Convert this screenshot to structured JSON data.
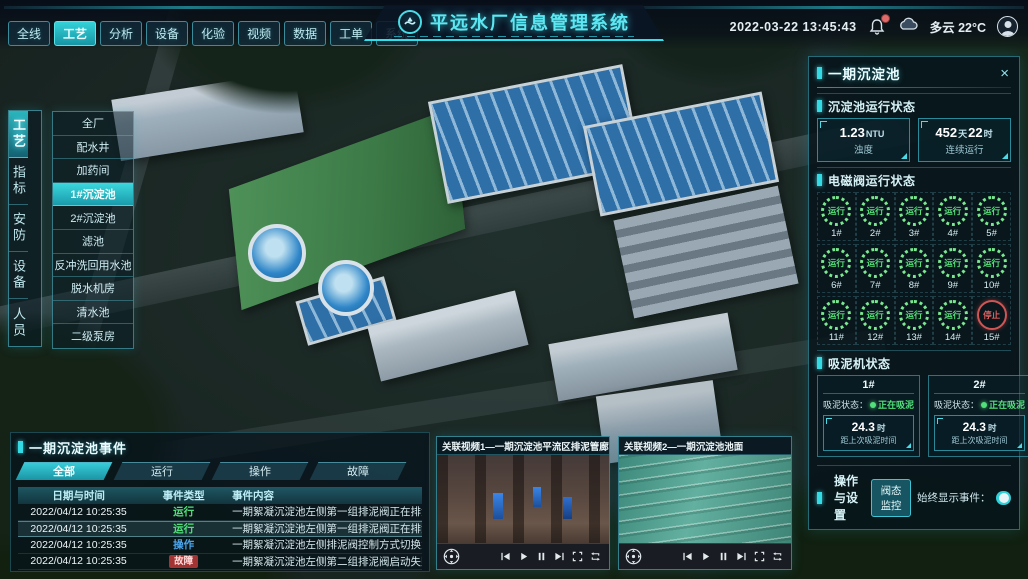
{
  "colors": {
    "accent": "#35dbe4",
    "run_green": "#52e07a",
    "op_blue": "#4aa3e8",
    "alarm_red": "#e05555",
    "panel_border": "#2f8fa3"
  },
  "icons": {
    "close": "×",
    "logo": "water-wave-logo",
    "alerts": "bell-icon",
    "weather": "cloud-icon",
    "user": "avatar-icon"
  },
  "header": {
    "title": "平远水厂信息管理系统",
    "datetime": "2022-03-22 13:45:43",
    "weather": "多云 22°C",
    "nav_tabs": [
      {
        "label": "全线"
      },
      {
        "label": "工艺",
        "active": true
      },
      {
        "label": "分析"
      },
      {
        "label": "设备"
      },
      {
        "label": "化验"
      },
      {
        "label": "视频"
      },
      {
        "label": "数据"
      },
      {
        "label": "工单"
      },
      {
        "label": "系统"
      }
    ]
  },
  "side_tabs": [
    {
      "label": "工艺",
      "active": true
    },
    {
      "label": "指标"
    },
    {
      "label": "安防"
    },
    {
      "label": "设备"
    },
    {
      "label": "人员"
    }
  ],
  "process_menu": {
    "items": [
      {
        "label": "全厂"
      },
      {
        "label": "配水井"
      },
      {
        "label": "加药间"
      },
      {
        "label": "1#沉淀池",
        "active": true
      },
      {
        "label": "2#沉淀池"
      },
      {
        "label": "滤池"
      },
      {
        "label": "反冲洗回用水池"
      },
      {
        "label": "脱水机房"
      },
      {
        "label": "清水池"
      },
      {
        "label": "二级泵房"
      }
    ]
  },
  "right_panel": {
    "title": "一期沉淀池",
    "close_icon": "×",
    "run_status": {
      "section_title": "沉淀池运行状态",
      "stats": [
        {
          "v1": "1.23",
          "u1": "NTU",
          "label": "浊度"
        },
        {
          "v1": "452",
          "u1": "天",
          "v2": "22",
          "u2": "时",
          "label": "连续运行"
        }
      ]
    },
    "valve_section": {
      "section_title": "电磁阀运行状态",
      "valves": [
        {
          "id": "1#",
          "status": "运行",
          "state": "run"
        },
        {
          "id": "2#",
          "status": "运行",
          "state": "run"
        },
        {
          "id": "3#",
          "status": "运行",
          "state": "run"
        },
        {
          "id": "4#",
          "status": "运行",
          "state": "run"
        },
        {
          "id": "5#",
          "status": "运行",
          "state": "run"
        },
        {
          "id": "6#",
          "status": "运行",
          "state": "run"
        },
        {
          "id": "7#",
          "status": "运行",
          "state": "run"
        },
        {
          "id": "8#",
          "status": "运行",
          "state": "run"
        },
        {
          "id": "9#",
          "status": "运行",
          "state": "run"
        },
        {
          "id": "10#",
          "status": "运行",
          "state": "run"
        },
        {
          "id": "11#",
          "status": "运行",
          "state": "run"
        },
        {
          "id": "12#",
          "status": "运行",
          "state": "run"
        },
        {
          "id": "13#",
          "status": "运行",
          "state": "run"
        },
        {
          "id": "14#",
          "status": "运行",
          "state": "run"
        },
        {
          "id": "15#",
          "status": "停止",
          "state": "stop"
        }
      ]
    },
    "mud_section": {
      "section_title": "吸泥机状态",
      "machines": [
        {
          "id": "1#",
          "status_label": "吸泥状态：",
          "status": "正在吸泥",
          "v": "24.3",
          "u": "时",
          "label": "距上次吸泥时间"
        },
        {
          "id": "2#",
          "status_label": "吸泥状态：",
          "status": "正在吸泥",
          "v": "24.3",
          "u": "时",
          "label": "距上次吸泥时间"
        }
      ]
    },
    "settings": {
      "section_title": "操作与设置",
      "button_label": "阀态监控",
      "toggle_label": "始终显示事件：",
      "toggle_state": "on"
    }
  },
  "events_panel": {
    "title": "一期沉淀池事件",
    "tabs": [
      {
        "label": "全部",
        "active": true
      },
      {
        "label": "运行"
      },
      {
        "label": "操作"
      },
      {
        "label": "故障"
      }
    ],
    "columns": [
      "日期与时间",
      "事件类型",
      "事件内容"
    ],
    "rows": [
      {
        "time": "2022/04/12 10:25:35",
        "type": "运行",
        "kind": "run",
        "content": "一期絮凝沉淀池左侧第一组排泥阀正在排泥"
      },
      {
        "time": "2022/04/12 10:25:35",
        "type": "运行",
        "kind": "run",
        "content": "一期絮凝沉淀池左侧第一组排泥阀正在排泥",
        "sel": true
      },
      {
        "time": "2022/04/12 10:25:35",
        "type": "操作",
        "kind": "op",
        "content": "一期絮凝沉淀池左侧排泥阀控制方式切换为手动"
      },
      {
        "time": "2022/04/12 10:25:35",
        "type": "故障",
        "kind": "fault",
        "content": "一期絮凝沉淀池左侧第二组排泥阀启动失败"
      }
    ]
  },
  "videos": [
    {
      "title": "关联视频1—一期沉淀池平流区排泥管廊",
      "scene": "pipe-gallery"
    },
    {
      "title": "关联视频2—一期沉淀池池面",
      "scene": "pool-surface"
    }
  ]
}
